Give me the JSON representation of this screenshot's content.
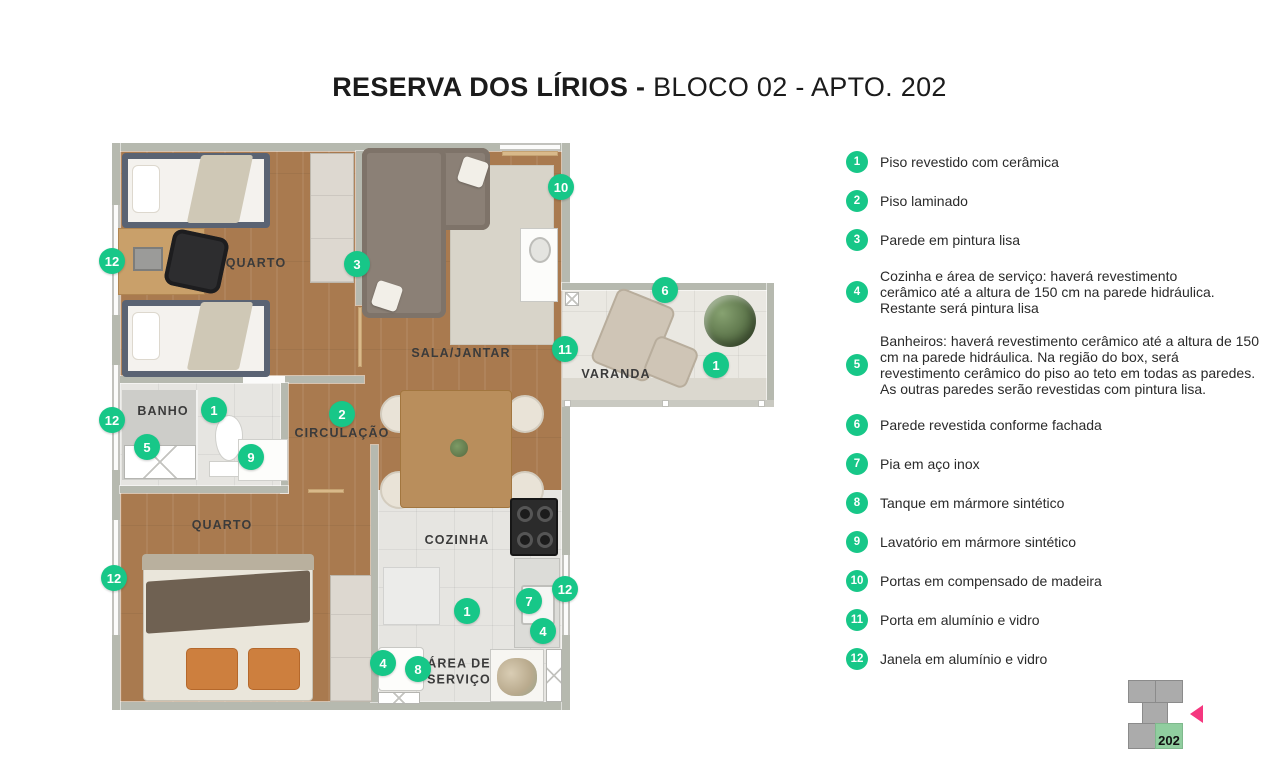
{
  "title": {
    "bold": "RESERVA DOS LÍRIOS -",
    "regular": " BLOCO 02 - APTO. 202"
  },
  "colors": {
    "marker_green": "#17c788",
    "arrow_pink": "#f5377f",
    "wall_gray": "#b6b9af",
    "wood": "#a97a4f",
    "tile": "#e6e5e1",
    "keyplan_gray": "#ababab",
    "keyplan_green": "#90ce9f"
  },
  "legend": {
    "items": [
      {
        "n": "1",
        "text": "Piso revestido com cerâmica"
      },
      {
        "n": "2",
        "text": "Piso laminado"
      },
      {
        "n": "3",
        "text": "Parede em pintura lisa"
      },
      {
        "n": "4",
        "text": "Cozinha e área de serviço: haverá revestimento\ncerâmico até a altura de 150 cm na parede hidráulica.\nRestante será pintura lisa"
      },
      {
        "n": "5",
        "text": "Banheiros: haverá revestimento cerâmico até a altura de 150\ncm na parede hidráulica. Na região do box, será\nrevestimento cerâmico do piso ao teto em todas as paredes.\nAs outras paredes serão revestidas com pintura lisa."
      },
      {
        "n": "6",
        "text": "Parede revestida conforme fachada"
      },
      {
        "n": "7",
        "text": "Pia em aço inox"
      },
      {
        "n": "8",
        "text": "Tanque em mármore sintético"
      },
      {
        "n": "9",
        "text": "Lavatório em mármore sintético"
      },
      {
        "n": "10",
        "text": "Portas em compensado de madeira"
      },
      {
        "n": "11",
        "text": "Porta em alumínio e vidro"
      },
      {
        "n": "12",
        "text": "Janela em alumínio e vidro"
      }
    ]
  },
  "plan": {
    "rooms": [
      {
        "name": "QUARTO",
        "x": 256,
        "y": 264
      },
      {
        "name": "SALA/JANTAR",
        "x": 461,
        "y": 354
      },
      {
        "name": "VARANDA",
        "x": 616,
        "y": 375
      },
      {
        "name": "BANHO",
        "x": 163,
        "y": 412
      },
      {
        "name": "CIRCULAÇÃO",
        "x": 342,
        "y": 434
      },
      {
        "name": "QUARTO",
        "x": 222,
        "y": 526
      },
      {
        "name": "COZINHA",
        "x": 457,
        "y": 541
      },
      {
        "name": "ÁREA DE\nSERVIÇO",
        "x": 459,
        "y": 672
      }
    ],
    "markers": [
      {
        "n": "10",
        "x": 561,
        "y": 187
      },
      {
        "n": "12",
        "x": 112,
        "y": 261
      },
      {
        "n": "3",
        "x": 357,
        "y": 264
      },
      {
        "n": "6",
        "x": 665,
        "y": 290
      },
      {
        "n": "11",
        "x": 565,
        "y": 349
      },
      {
        "n": "1",
        "x": 716,
        "y": 365
      },
      {
        "n": "1",
        "x": 214,
        "y": 410
      },
      {
        "n": "2",
        "x": 342,
        "y": 414
      },
      {
        "n": "12",
        "x": 112,
        "y": 420
      },
      {
        "n": "5",
        "x": 147,
        "y": 447
      },
      {
        "n": "9",
        "x": 251,
        "y": 457
      },
      {
        "n": "12",
        "x": 114,
        "y": 578
      },
      {
        "n": "12",
        "x": 565,
        "y": 589
      },
      {
        "n": "7",
        "x": 529,
        "y": 601
      },
      {
        "n": "1",
        "x": 467,
        "y": 611
      },
      {
        "n": "4",
        "x": 543,
        "y": 631
      },
      {
        "n": "4",
        "x": 383,
        "y": 663
      },
      {
        "n": "8",
        "x": 418,
        "y": 669
      }
    ]
  },
  "keyplan": {
    "unit_label": "202"
  }
}
